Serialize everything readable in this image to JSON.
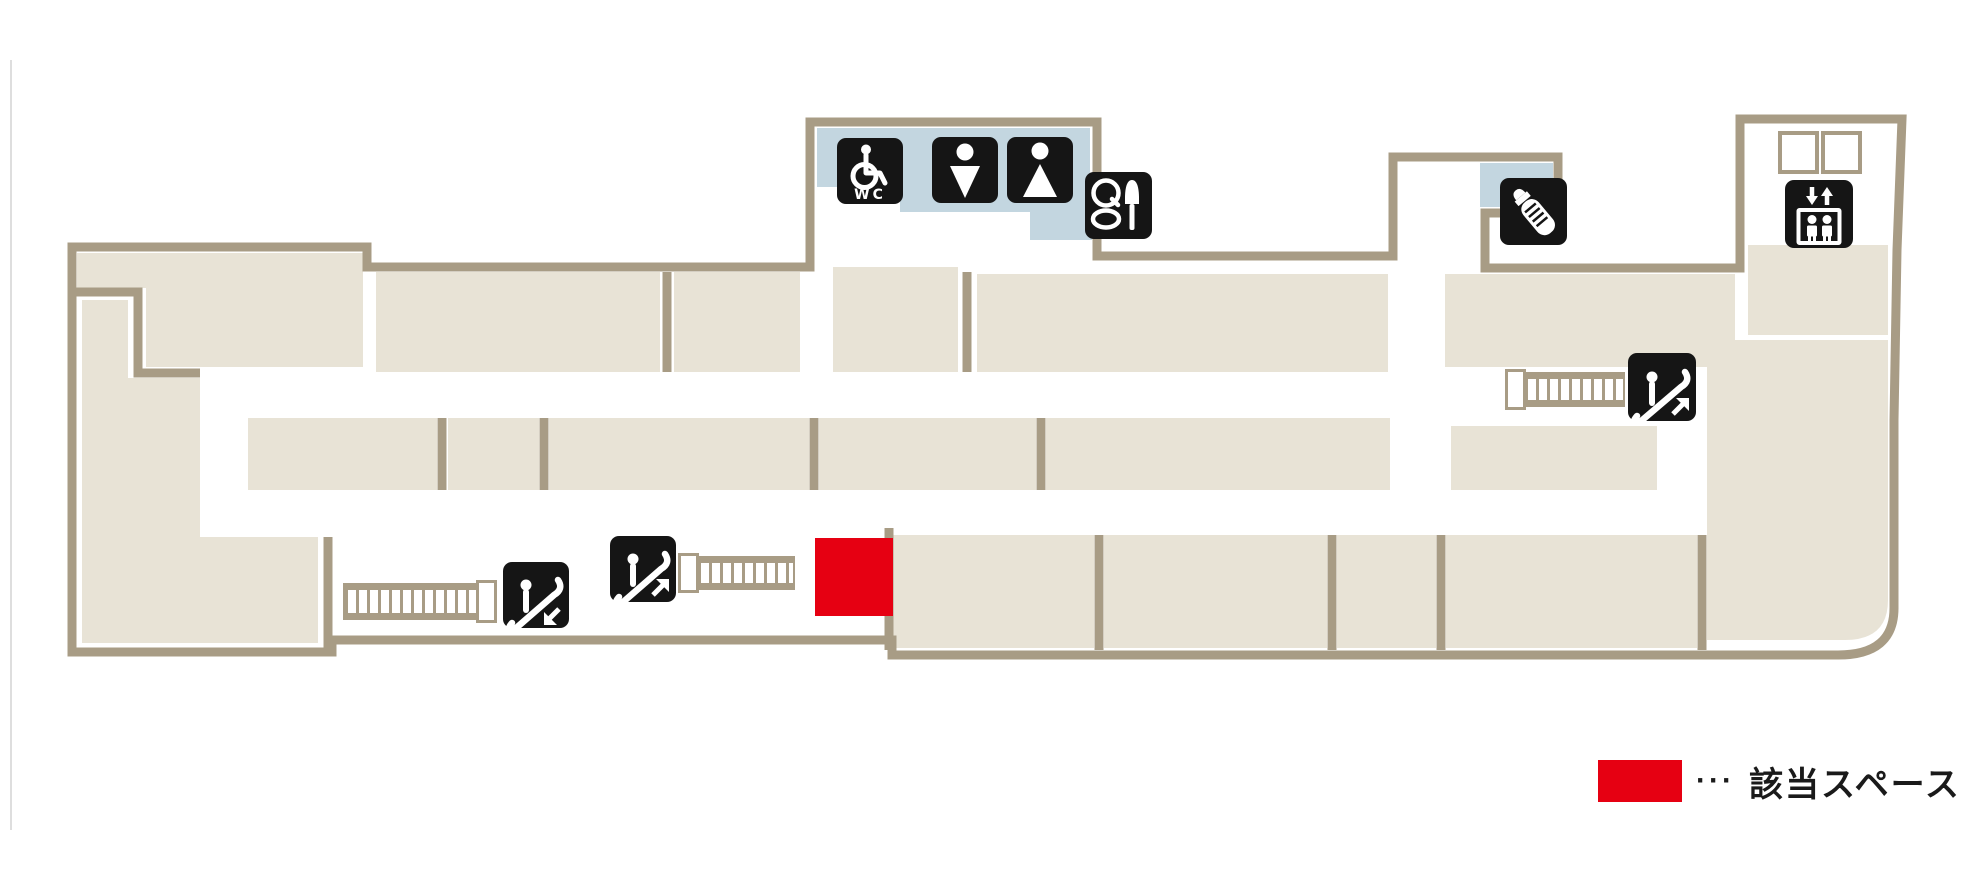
{
  "page": {
    "background": "#ffffff"
  },
  "floor_map": {
    "colors": {
      "shop_block": "#e8e3d6",
      "wall": "#a89c85",
      "restroom_area_blue": "#c3d6e0",
      "highlight_red": "#e60012",
      "icon_background": "#151515",
      "icon_glyph": "#ffffff"
    },
    "facility_icons": [
      {
        "id": "wheelchair-accessible-toilet",
        "text": "WC"
      },
      {
        "id": "mens-toilet"
      },
      {
        "id": "womens-toilet"
      },
      {
        "id": "powder-room"
      },
      {
        "id": "baby-room"
      },
      {
        "id": "elevator"
      },
      {
        "id": "escalator-up-right-wing"
      },
      {
        "id": "escalator-down-left-wing"
      },
      {
        "id": "escalator-up-left-wing"
      }
    ],
    "wc_text": "WC"
  },
  "legend": {
    "dots": "···",
    "label": "該当スペース",
    "swatch_color": "#e60012"
  }
}
